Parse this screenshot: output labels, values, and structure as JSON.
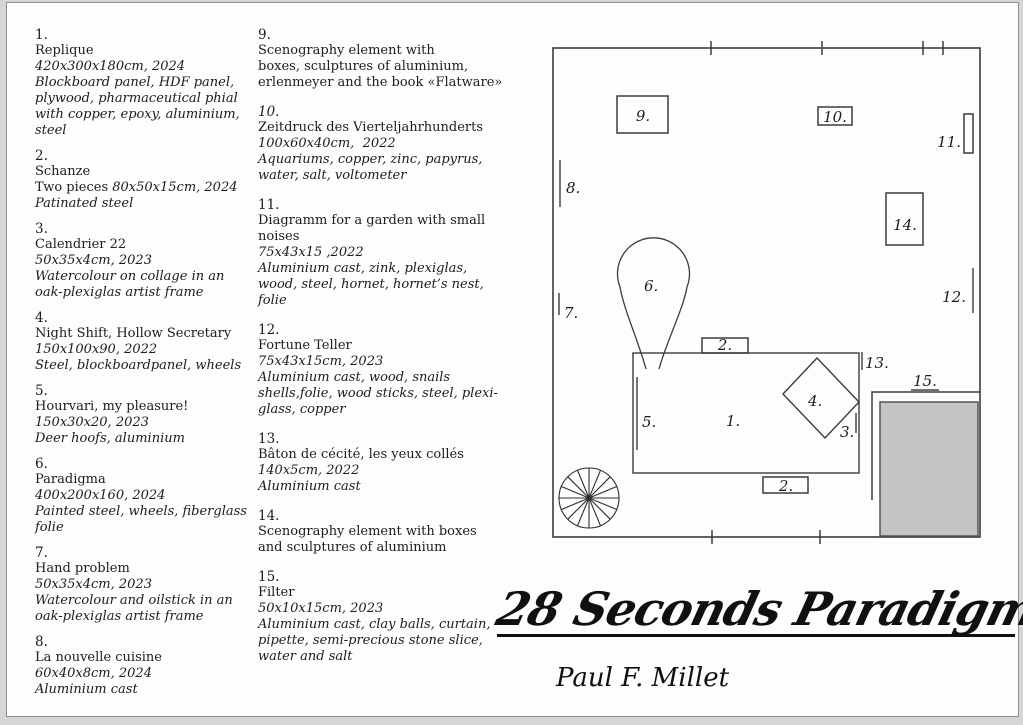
{
  "colors": {
    "page_bg": "#fdfdfd",
    "outer_bg": "#d6d6d6",
    "line": "#3c3c3c",
    "gray_fill": "#c4c4c4",
    "text": "#1c1c1c"
  },
  "catalog": {
    "columns": [
      {
        "items": [
          {
            "number": "1.",
            "lines": [
              [
                [
                  "Replique",
                  false
                ]
              ],
              [
                [
                  "420x300x180cm, 2024",
                  true
                ]
              ],
              [
                [
                  "Blockboard panel, HDF panel,",
                  true
                ]
              ],
              [
                [
                  "plywood, pharmaceutical phial",
                  true
                ]
              ],
              [
                [
                  "with copper, epoxy, aluminium,",
                  true
                ]
              ],
              [
                [
                  "steel",
                  true
                ]
              ]
            ]
          },
          {
            "number": "2.",
            "lines": [
              [
                [
                  "Schanze",
                  false
                ]
              ],
              [
                [
                  "Two pieces ",
                  false
                ],
                [
                  "80x50x15cm, 2024",
                  true
                ]
              ],
              [
                [
                  "Patinated steel",
                  true
                ]
              ]
            ]
          },
          {
            "number": "3.",
            "lines": [
              [
                [
                  "Calendrier 22",
                  false
                ]
              ],
              [
                [
                  "50x35x4cm, 2023",
                  true
                ]
              ],
              [
                [
                  "Watercolour on collage in an",
                  true
                ]
              ],
              [
                [
                  "oak-plexiglas artist frame",
                  true
                ]
              ]
            ]
          },
          {
            "number": "4.",
            "lines": [
              [
                [
                  "Night Shift, Hollow Secretary",
                  false
                ]
              ],
              [
                [
                  "150x100x90, 2022",
                  true
                ]
              ],
              [
                [
                  "Steel, blockboardpanel, wheels",
                  true
                ]
              ]
            ]
          },
          {
            "number": "5.",
            "lines": [
              [
                [
                  "Hourvari, my pleasure!",
                  false
                ]
              ],
              [
                [
                  "150x30x20, 2023",
                  true
                ]
              ],
              [
                [
                  "Deer hoofs, aluminium",
                  true
                ]
              ]
            ]
          },
          {
            "number": "6.",
            "lines": [
              [
                [
                  "Paradigma",
                  false
                ]
              ],
              [
                [
                  "400x200x160, 2024",
                  true
                ]
              ],
              [
                [
                  "Painted steel, wheels, fiberglass",
                  true
                ]
              ],
              [
                [
                  "folie",
                  true
                ]
              ]
            ]
          },
          {
            "number": "7.",
            "lines": [
              [
                [
                  "Hand problem",
                  false
                ]
              ],
              [
                [
                  "50x35x4cm, 2023",
                  true
                ]
              ],
              [
                [
                  "Watercolour and oilstick in an",
                  true
                ]
              ],
              [
                [
                  "oak-plexiglas artist frame",
                  true
                ]
              ]
            ]
          },
          {
            "number": "8.",
            "lines": [
              [
                [
                  "La nouvelle cuisine",
                  false
                ]
              ],
              [
                [
                  "60x40x8cm, 2024",
                  true
                ]
              ],
              [
                [
                  "Aluminium cast",
                  true
                ]
              ]
            ]
          }
        ]
      },
      {
        "items": [
          {
            "number": "9.",
            "lines": [
              [
                [
                  "Scenography element with",
                  false
                ]
              ],
              [
                [
                  "boxes, sculptures of aluminium,",
                  false
                ]
              ],
              [
                [
                  "erlenmeyer and the book «Flatware»",
                  false
                ]
              ]
            ]
          },
          {
            "number": "10.",
            "italic_number": true,
            "lines": [
              [
                [
                  "Zeitdruck des Vierteljahrhunderts",
                  false
                ]
              ],
              [
                [
                  "100x60x40cm,  2022",
                  true
                ]
              ],
              [
                [
                  "Aquariums, copper, zinc, papyrus,",
                  true
                ]
              ],
              [
                [
                  "water, salt, voltometer",
                  true
                ]
              ]
            ]
          },
          {
            "number": "11.",
            "lines": [
              [
                [
                  "Diagramm for a garden with small",
                  false
                ]
              ],
              [
                [
                  "noises",
                  false
                ]
              ],
              [
                [
                  "75x43x15 ,2022",
                  true
                ]
              ],
              [
                [
                  "Aluminium cast, zink, plexiglas,",
                  true
                ]
              ],
              [
                [
                  "wood, steel, hornet, hornet’s nest,",
                  true
                ]
              ],
              [
                [
                  "folie",
                  true
                ]
              ]
            ]
          },
          {
            "number": "12.",
            "lines": [
              [
                [
                  "Fortune Teller",
                  false
                ]
              ],
              [
                [
                  "75x43x15cm, 2023",
                  true
                ]
              ],
              [
                [
                  "Aluminium cast, wood, snails",
                  true
                ]
              ],
              [
                [
                  "shells,folie, wood sticks, steel, plexi-",
                  true
                ]
              ],
              [
                [
                  "glass, copper",
                  true
                ]
              ]
            ]
          },
          {
            "number": "13.",
            "lines": [
              [
                [
                  "Bâton de cécité, les yeux collés",
                  false
                ]
              ],
              [
                [
                  "140x5cm, 2022",
                  true
                ]
              ],
              [
                [
                  "Aluminium cast",
                  true
                ]
              ]
            ]
          },
          {
            "number": "14.",
            "lines": [
              [
                [
                  "Scenography element with boxes",
                  false
                ]
              ],
              [
                [
                  "and sculptures of aluminium",
                  false
                ]
              ]
            ]
          },
          {
            "number": "15.",
            "lines": [
              [
                [
                  "Filter",
                  false
                ]
              ],
              [
                [
                  "50x10x15cm, 2023",
                  true
                ]
              ],
              [
                [
                  "Aluminium cast, clay balls, curtain,",
                  true
                ]
              ],
              [
                [
                  "pipette, semi-precious stone slice,",
                  true
                ]
              ],
              [
                [
                  "water and salt",
                  true
                ]
              ]
            ]
          }
        ]
      }
    ]
  },
  "plan": {
    "labels": {
      "n1": "1.",
      "n2_top": "2.",
      "n2_bottom": "2.",
      "n3": "3.",
      "n4": "4.",
      "n5": "5.",
      "n6": "6.",
      "n7": "7.",
      "n8": "8.",
      "n9": "9.",
      "n10": "10.",
      "n11": "11.",
      "n12": "12.",
      "n13": "13.",
      "n14": "14.",
      "n15": "15."
    }
  },
  "signature": {
    "title": "28 Seconds Paradigma",
    "artist": "Paul F. Millet"
  }
}
